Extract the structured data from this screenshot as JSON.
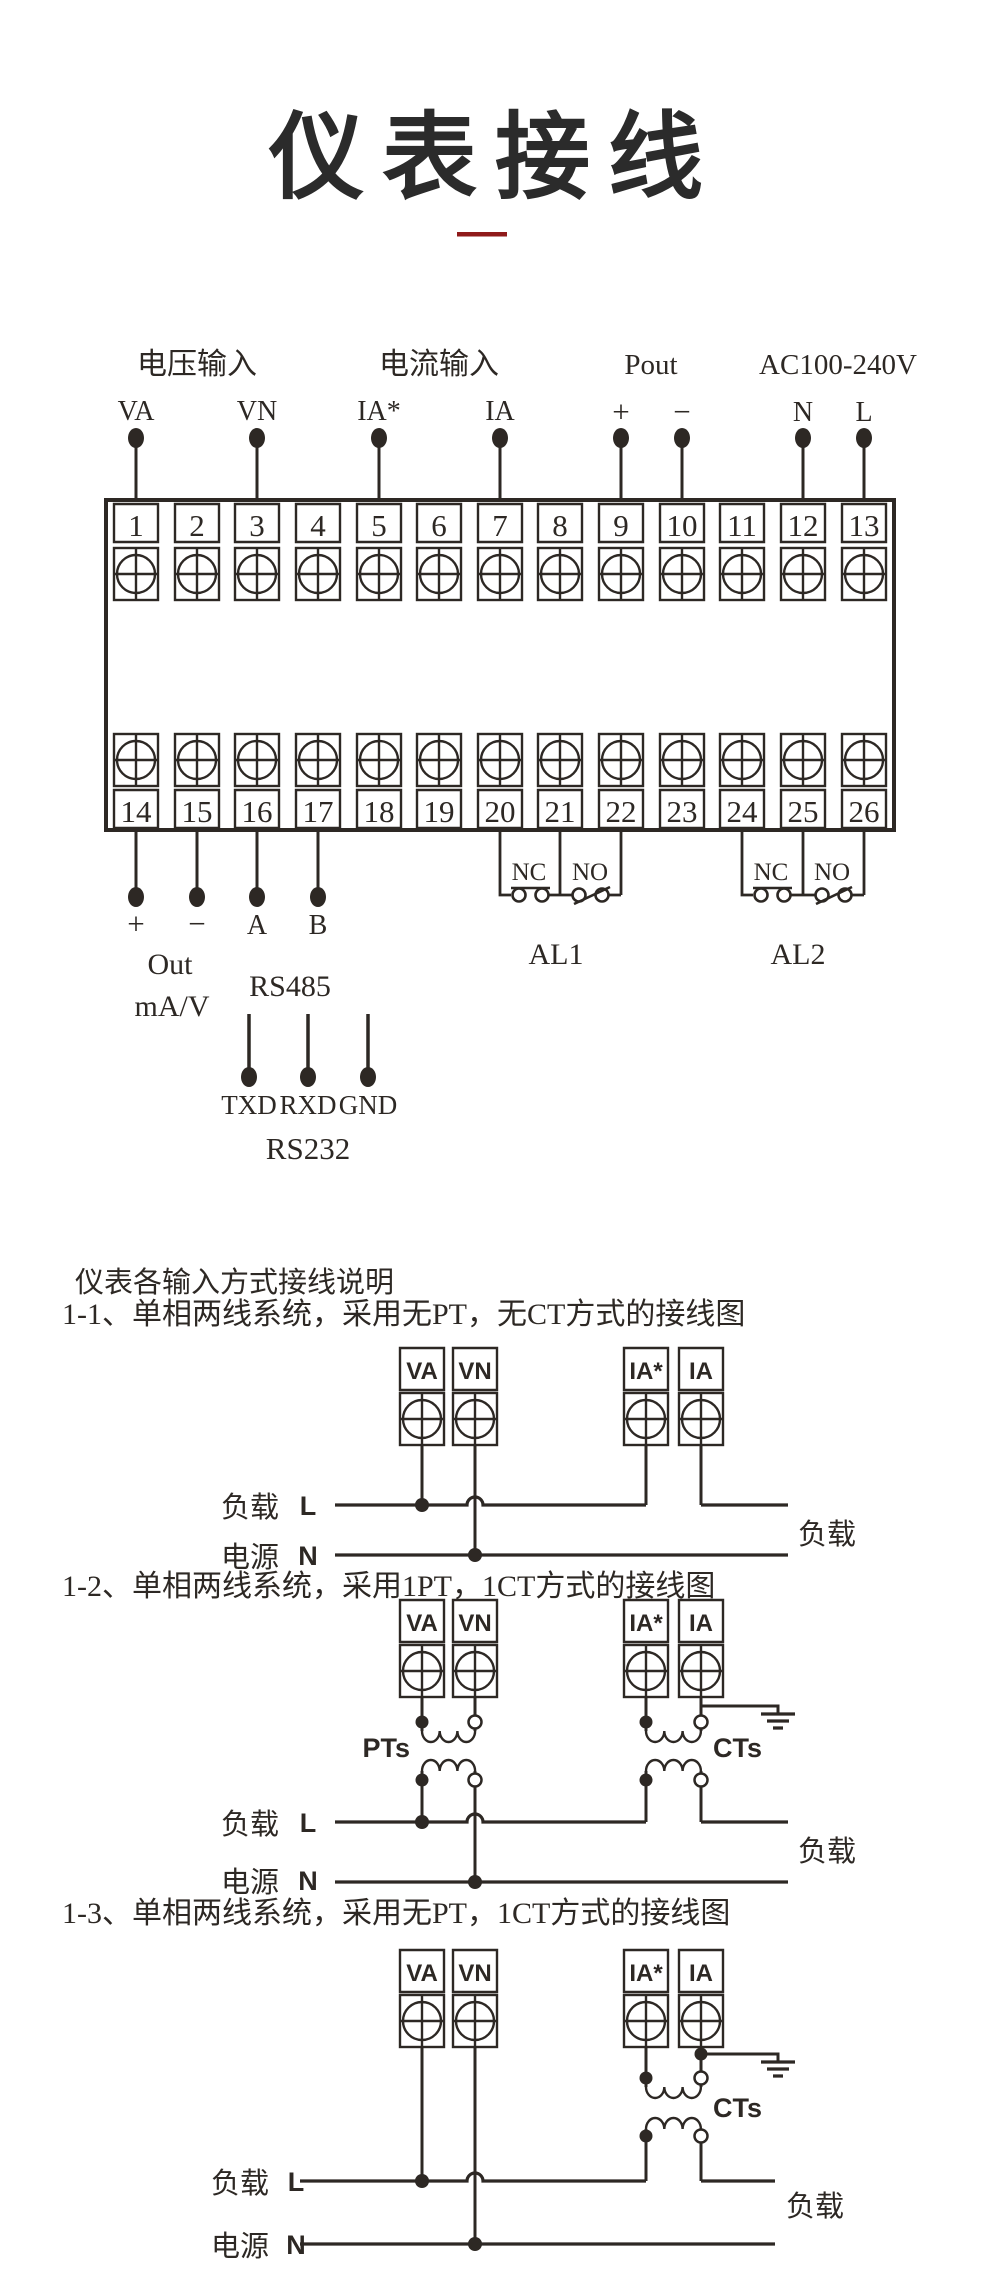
{
  "header": {
    "title": "仪表接线",
    "accent_color": "#8f1a1a",
    "ink_color": "#2d2824"
  },
  "terminal_block": {
    "groups": [
      {
        "label": "电压输入",
        "pins": [
          "VA",
          "VN"
        ]
      },
      {
        "label": "电流输入",
        "pins": [
          "IA*",
          "IA"
        ]
      },
      {
        "label": "Pout",
        "pins": [
          "+",
          "−"
        ]
      },
      {
        "label": "AC100-240V",
        "pins": [
          "N",
          "L"
        ]
      }
    ],
    "top_terminals": [
      "1",
      "2",
      "3",
      "4",
      "5",
      "6",
      "7",
      "8",
      "9",
      "10",
      "11",
      "12",
      "13"
    ],
    "bottom_terminals": [
      "14",
      "15",
      "16",
      "17",
      "18",
      "19",
      "20",
      "21",
      "22",
      "23",
      "24",
      "25",
      "26"
    ],
    "analog_out": {
      "plus": "+",
      "minus": "−",
      "label": "Out",
      "unit": "mA/V"
    },
    "rs485": {
      "a": "A",
      "b": "B",
      "label": "RS485"
    },
    "relays": [
      {
        "name": "AL1",
        "contacts": [
          "NC",
          "NO"
        ]
      },
      {
        "name": "AL2",
        "contacts": [
          "NC",
          "NO"
        ]
      }
    ],
    "rs232": {
      "label": "RS232",
      "pins": [
        "TXD",
        "RXD",
        "GND"
      ]
    }
  },
  "sections": {
    "intro": "仪表各输入方式接线说明",
    "items": [
      {
        "title": "1-1、单相两线系统，采用无PT，无CT方式的接线图"
      },
      {
        "title": "1-2、单相两线系统，采用1PT，1CT方式的接线图"
      },
      {
        "title": "1-3、单相两线系统，采用无PT，1CT方式的接线图"
      }
    ]
  },
  "diagram": {
    "terminals": [
      "VA",
      "VN",
      "IA*",
      "IA"
    ],
    "load": "负载",
    "source": "电源",
    "live": "L",
    "neutral": "N",
    "load_right": "负载",
    "pt": "PTs",
    "ct": "CTs"
  }
}
